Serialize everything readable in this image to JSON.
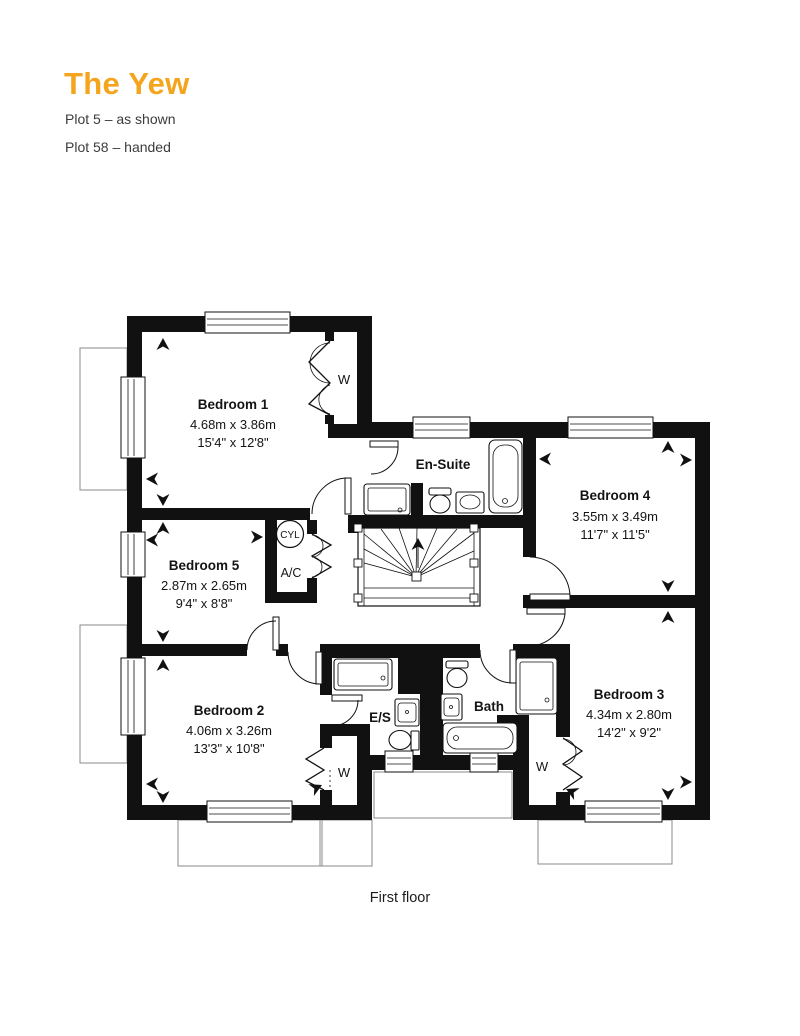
{
  "header": {
    "title": "The Yew",
    "plots": [
      {
        "label": "Plot 5 – as shown"
      },
      {
        "label": "Plot 58 – handed"
      }
    ]
  },
  "floor_label": "First floor",
  "colors": {
    "accent": "#F5A41E",
    "line": "#111111",
    "muted_line": "#8a8a8a",
    "text": "#1c1c1c"
  },
  "rooms": {
    "bedroom1": {
      "name": "Bedroom 1",
      "metric": "4.68m x 3.86m",
      "imperial": "15'4\" x 12'8\""
    },
    "bedroom2": {
      "name": "Bedroom 2",
      "metric": "4.06m x 3.26m",
      "imperial": "13'3\" x 10'8\""
    },
    "bedroom3": {
      "name": "Bedroom 3",
      "metric": "4.34m x 2.80m",
      "imperial": "14'2\" x 9'2\""
    },
    "bedroom4": {
      "name": "Bedroom 4",
      "metric": "3.55m x 3.49m",
      "imperial": "11'7\" x 11'5\""
    },
    "bedroom5": {
      "name": "Bedroom 5",
      "metric": "2.87m x 2.65m",
      "imperial": "9'4\" x 8'8\""
    },
    "ensuite": {
      "name": "En-Suite"
    },
    "es": {
      "name": "E/S"
    },
    "bath": {
      "name": "Bath"
    }
  },
  "labels": {
    "wardrobe": "W",
    "cylinder": "CYL",
    "airing": "A/C"
  }
}
